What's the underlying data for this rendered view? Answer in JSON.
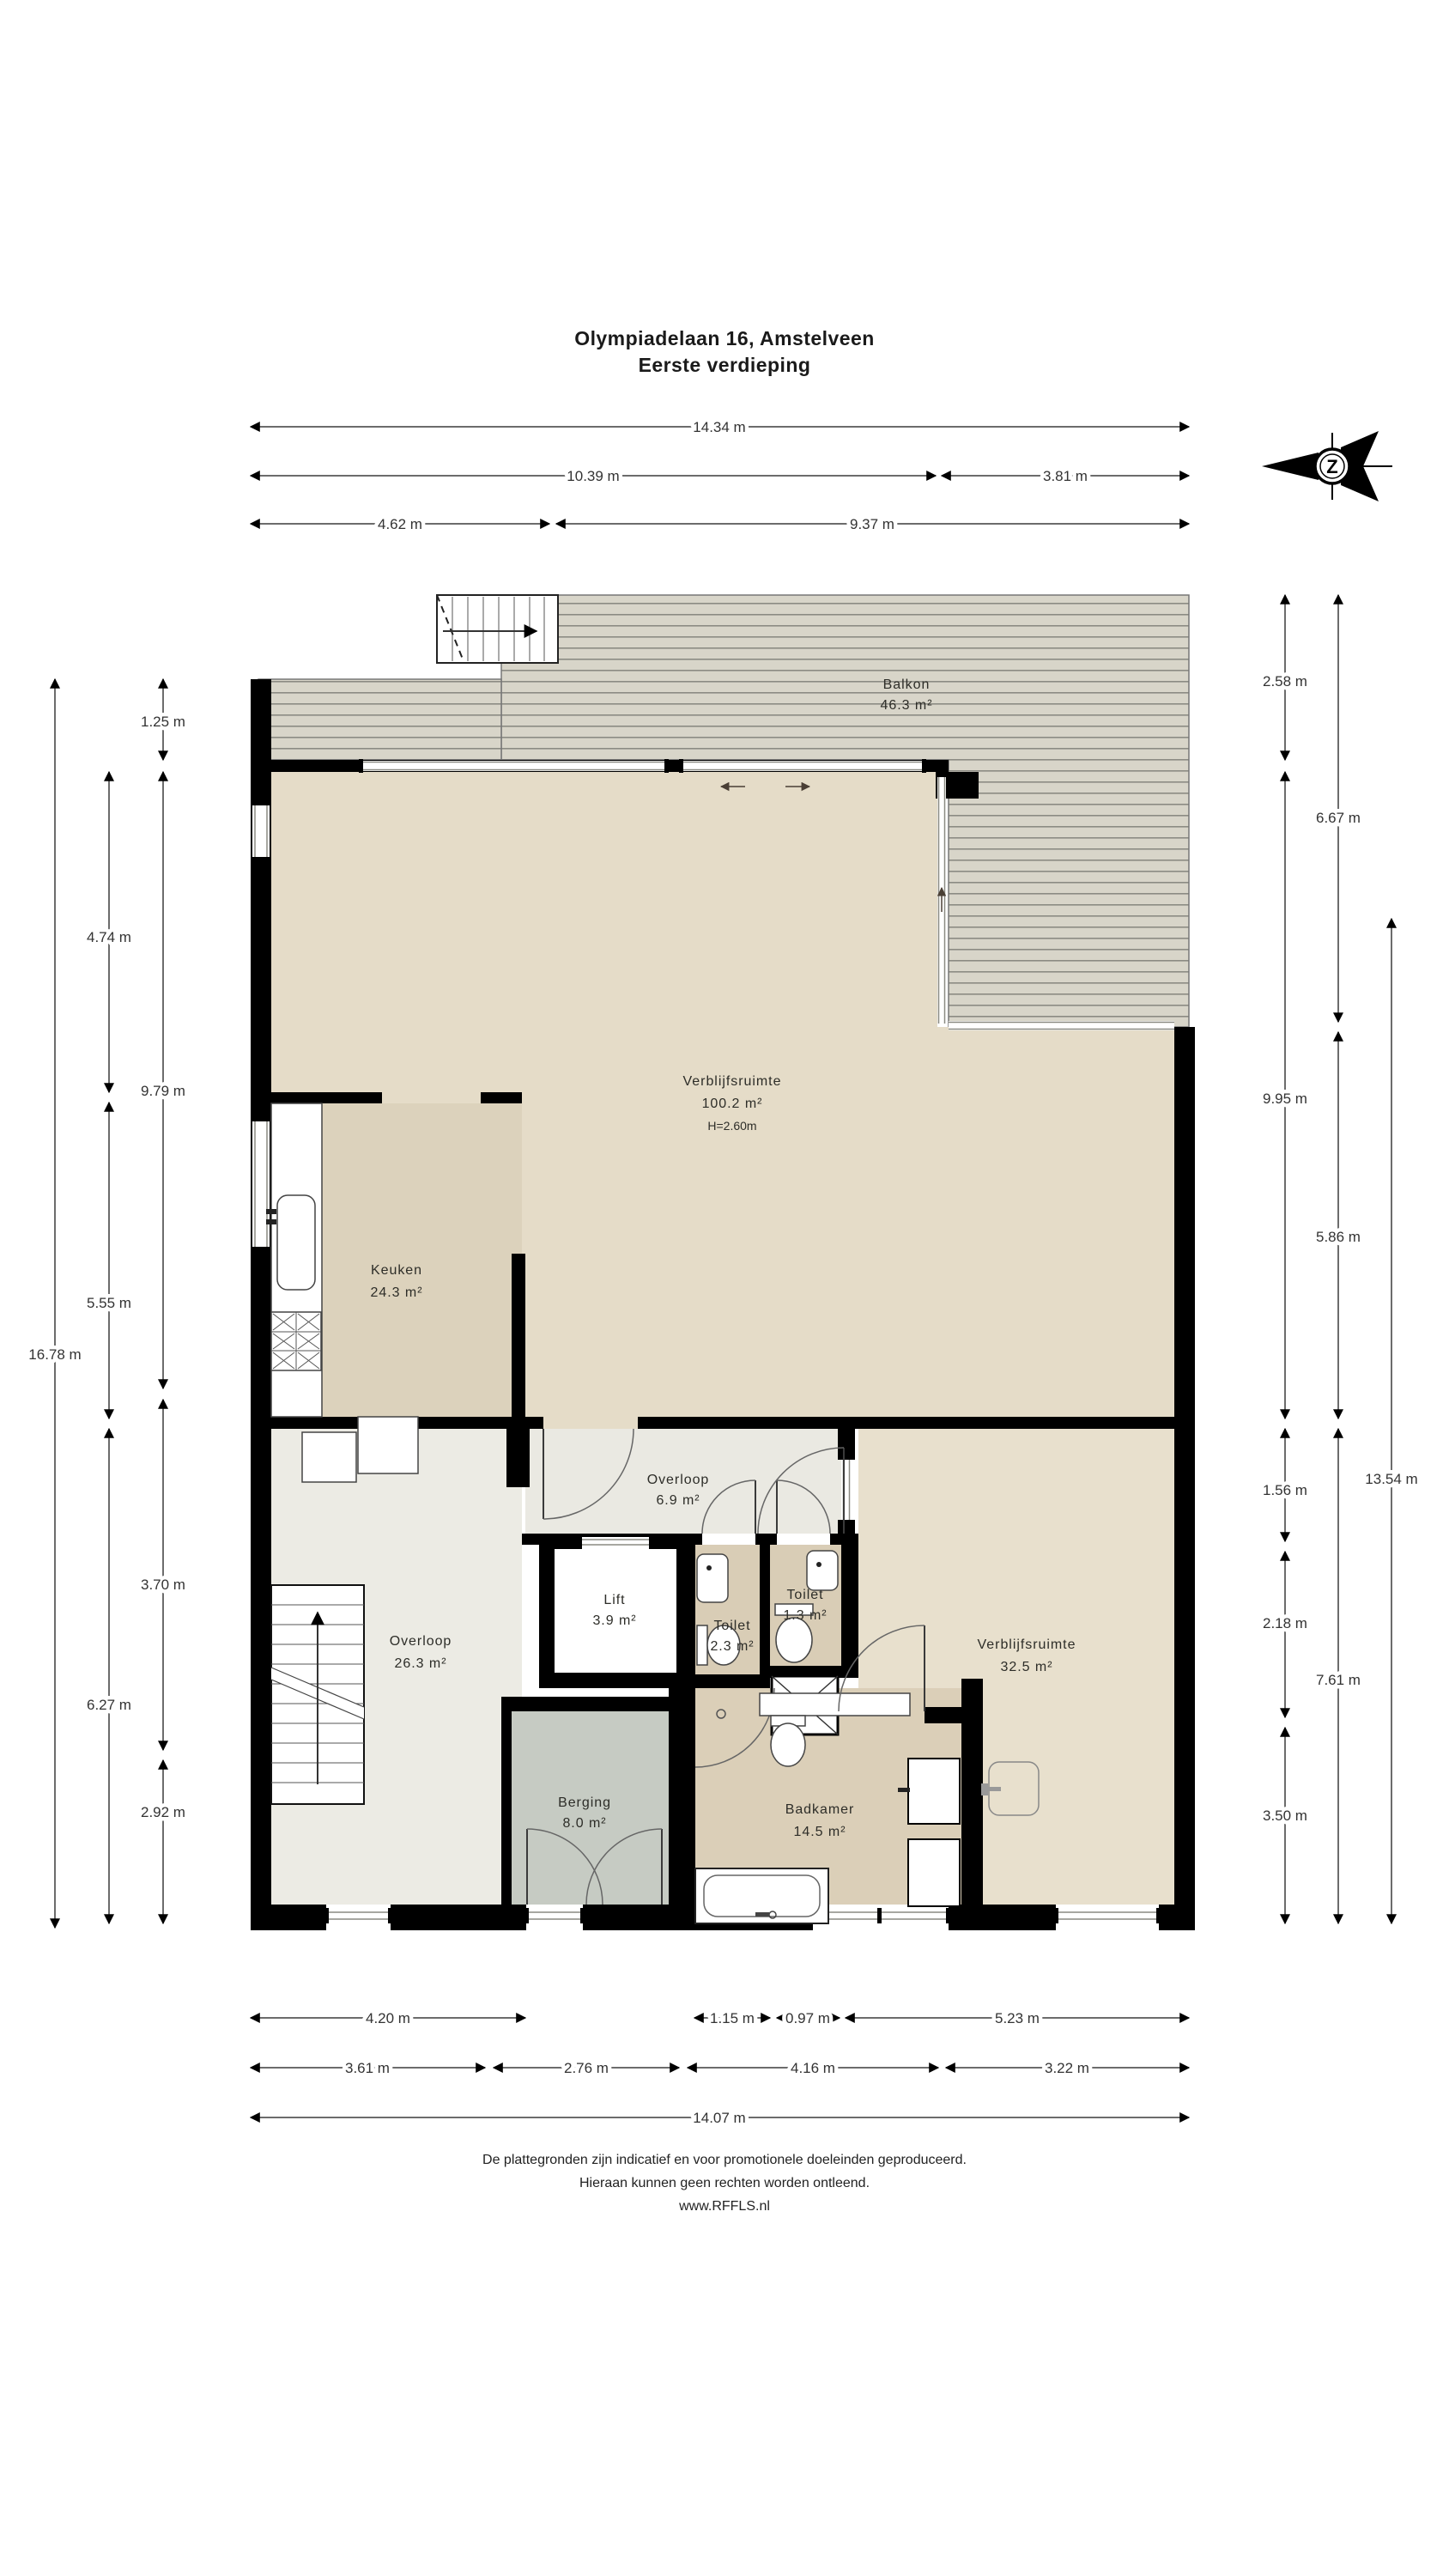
{
  "title": {
    "line1": "Olympiadelaan 16, Amstelveen",
    "line2": "Eerste verdieping"
  },
  "compass": {
    "letter": "Z"
  },
  "rooms": {
    "balkon": {
      "name": "Balkon",
      "area": "46.3 m²"
    },
    "verblijf_boven": {
      "name": "Verblijfsruimte",
      "area": "100.2 m²",
      "height": "H=2.60m"
    },
    "keuken": {
      "name": "Keuken",
      "area": "24.3 m²"
    },
    "overloop_klein": {
      "name": "Overloop",
      "area": "6.9 m²"
    },
    "lift": {
      "name": "Lift",
      "area": "3.9 m²"
    },
    "toilet_klein": {
      "name": "Toilet",
      "area": "1.3 m²"
    },
    "toilet": {
      "name": "Toilet",
      "area": "2.3 m²"
    },
    "overloop_groot": {
      "name": "Overloop",
      "area": "26.3 m²"
    },
    "verblijf_rechts": {
      "name": "Verblijfsruimte",
      "area": "32.5 m²"
    },
    "berging": {
      "name": "Berging",
      "area": "8.0 m²"
    },
    "badkamer": {
      "name": "Badkamer",
      "area": "14.5 m²"
    }
  },
  "dims": {
    "top_total": "14.34 m",
    "top_left": "10.39 m",
    "top_right": "3.81 m",
    "top_row3_left": "4.62 m",
    "top_row3_right": "9.37 m",
    "left_outer": "16.78 m",
    "left_mid_1": "4.74 m",
    "left_mid_2": "5.55 m",
    "left_mid_3": "6.27 m",
    "left_in_1": "1.25 m",
    "left_in_2": "9.79 m",
    "left_in_3": "3.70 m",
    "left_in_4": "2.92 m",
    "right_in_1": "2.58 m",
    "right_in_2": "9.95 m",
    "right_in_3": "1.56 m",
    "right_in_4": "2.18 m",
    "right_in_5": "3.50 m",
    "right_mid_1": "6.67 m",
    "right_mid_2": "5.86 m",
    "right_mid_3": "7.61 m",
    "right_outer": "13.54 m",
    "bot_r1_1": "4.20 m",
    "bot_r1_2": "1.15 m",
    "bot_r1_3": "0.97 m",
    "bot_r1_4": "5.23 m",
    "bot_r2_1": "3.61 m",
    "bot_r2_2": "2.76 m",
    "bot_r2_3": "4.16 m",
    "bot_r2_4": "3.22 m",
    "bot_total": "14.07 m"
  },
  "footer": {
    "line1": "De plattegronden zijn indicatief en voor promotionele doeleinden geproduceerd.",
    "line2": "Hieraan kunnen geen rechten worden ontleend.",
    "line3": "www.RFFLS.nl"
  },
  "colors": {
    "wall": "#000000",
    "living": "#e5dcc8",
    "kitchen": "#dcd2bc",
    "bathroom": "#dbcfb8",
    "toilet": "#d9cdb6",
    "hallway": "#ecebe4",
    "hallway_small": "#eae9e2",
    "storage": "#c6cbc3",
    "living_right": "#e8e0cd",
    "deck_base": "#d8d5c9",
    "deck_line": "#8b8b83"
  }
}
